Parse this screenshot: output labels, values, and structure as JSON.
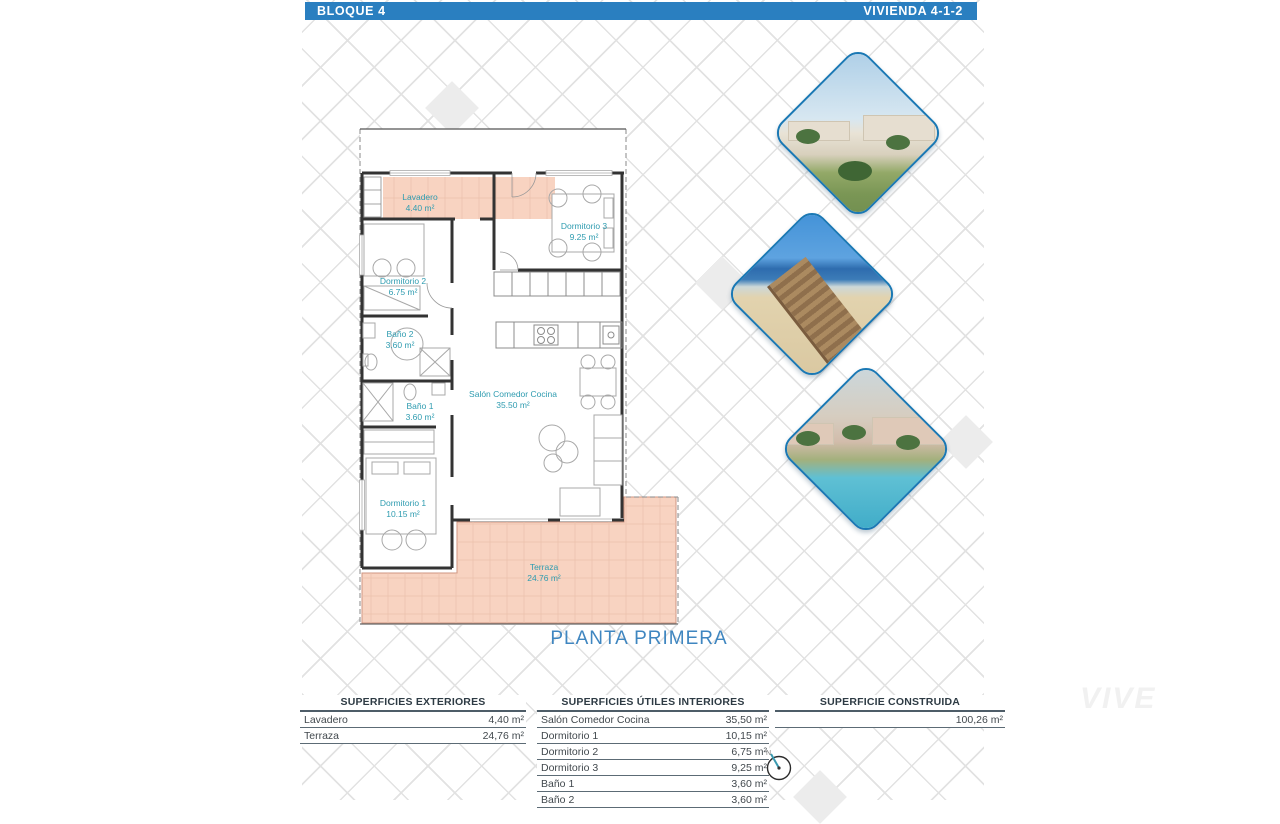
{
  "header": {
    "left_label": "BLOQUE 4",
    "right_label": "VIVIENDA 4-1-2",
    "bar_color": "#2a7fc0"
  },
  "plan": {
    "title": "PLANTA PRIMERA",
    "compass_label": "N",
    "rooms": [
      {
        "name": "Lavadero",
        "area": "4.40 m²"
      },
      {
        "name": "Dormitorio 3",
        "area": "9.25 m²"
      },
      {
        "name": "Dormitorio 2",
        "area": "6.75 m²"
      },
      {
        "name": "Baño 2",
        "area": "3.60 m²"
      },
      {
        "name": "Baño 1",
        "area": "3.60 m²"
      },
      {
        "name": "Salón Comedor Cocina",
        "area": "35.50 m²"
      },
      {
        "name": "Dormitorio 1",
        "area": "10.15 m²"
      },
      {
        "name": "Terraza",
        "area": "24.76 m²"
      }
    ]
  },
  "images": [
    {
      "name": "resort-exterior-render"
    },
    {
      "name": "beach-boardwalk-photo"
    },
    {
      "name": "pool-apartments-render"
    }
  ],
  "tables": {
    "exteriores": {
      "title": "SUPERFICIES EXTERIORES",
      "rows": [
        {
          "label": "Lavadero",
          "value": "4,40 m²"
        },
        {
          "label": "Terraza",
          "value": "24,76 m²"
        }
      ]
    },
    "interiores": {
      "title": "SUPERFICIES ÚTILES INTERIORES",
      "rows": [
        {
          "label": "Salón Comedor Cocina",
          "value": "35,50 m²"
        },
        {
          "label": "Dormitorio 1",
          "value": "10,15 m²"
        },
        {
          "label": "Dormitorio 2",
          "value": "6,75 m²"
        },
        {
          "label": "Dormitorio 3",
          "value": "9,25 m²"
        },
        {
          "label": "Baño 1",
          "value": "3,60 m²"
        },
        {
          "label": "Baño 2",
          "value": "3,60 m²"
        }
      ]
    },
    "construida": {
      "title": "SUPERFICIE CONSTRUIDA",
      "rows": [
        {
          "label": "",
          "value": "100,26 m²"
        }
      ]
    }
  },
  "watermark": "VIVE",
  "colors": {
    "accent_blue": "#2a7fc0",
    "room_label_teal": "#2f9cb0",
    "plan_title_blue": "#3f86c0",
    "terrace_pink": "#f8d3c1",
    "diamond_border_blue": "#1a78b4"
  }
}
